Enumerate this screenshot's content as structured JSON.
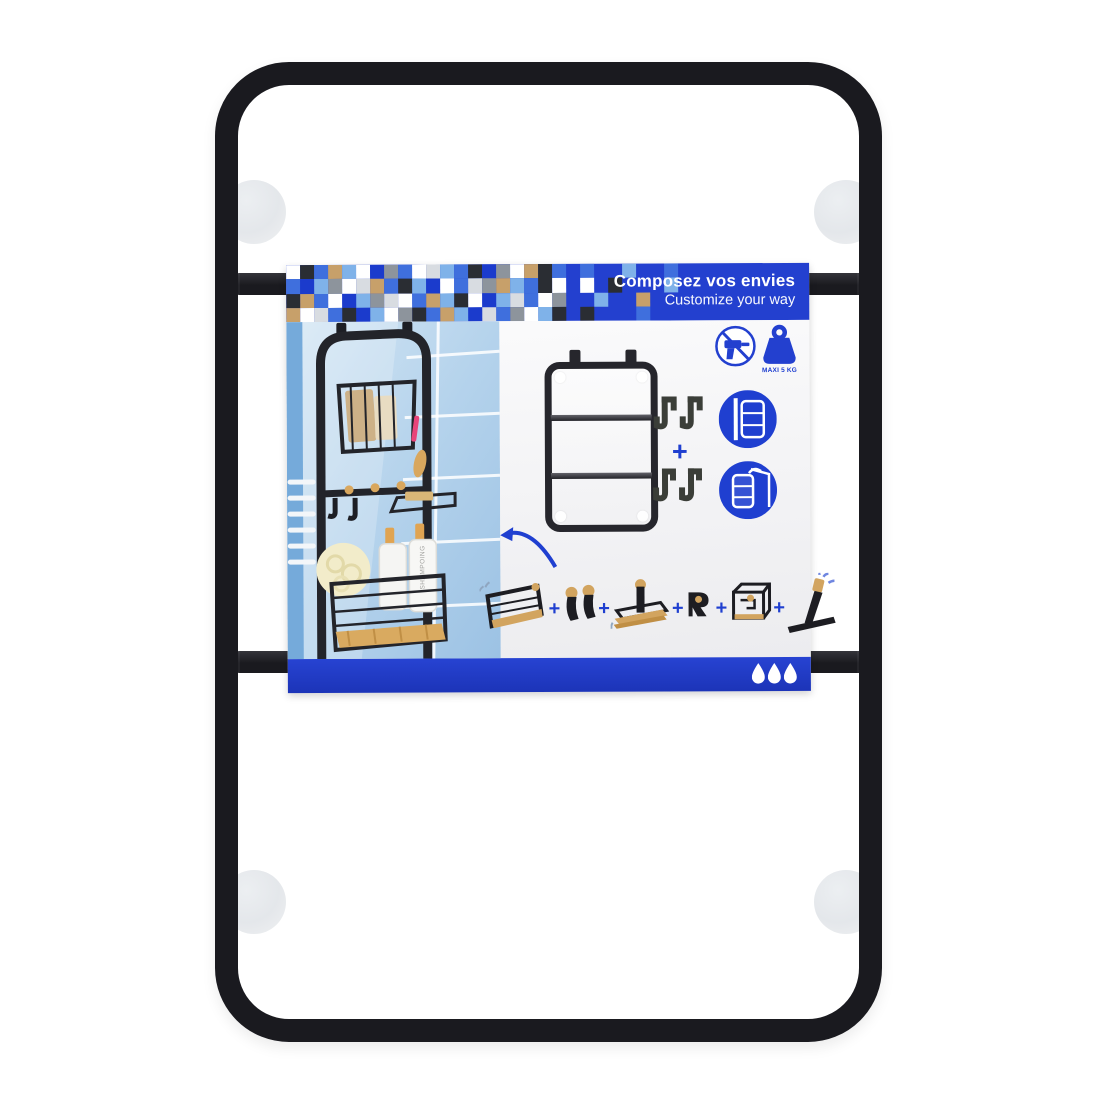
{
  "product": {
    "type": "suction-mount-bathroom-rack",
    "frame_bars": 2,
    "suction_cups": 4
  },
  "package": {
    "banner": {
      "title_fr": "Composez vos envies",
      "subtitle_en": "Customize your way",
      "mosaic_palette": [
        "#1b3bcc",
        "#3f6fdd",
        "#7fb2e9",
        "#ffffff",
        "#d8dce1",
        "#8d949c",
        "#2a2d33",
        "#c7a06a"
      ],
      "mosaic_rows": [
        "36172305134216053761.1..2..1..",
        "10253471620314572163.3.6...2..",
        "67130254317263024135..2..7....",
        "73416023561720415326.6...1...."
      ]
    },
    "badges": {
      "weight_limit_label": "MAXI 5 KG"
    },
    "assembly": {
      "plus_sign": "+"
    },
    "bottle_label": "SHAMPOING",
    "accessories": [
      "wire-basket",
      "peg-hooks",
      "stack-shelf",
      "single-hook",
      "cube-basket",
      "squeegee"
    ],
    "mount_options": [
      "wall-suction-mount",
      "over-door-hang"
    ],
    "hook_sets": [
      "s-hooks",
      "j-hooks"
    ],
    "footer_drops": 3
  },
  "colors": {
    "banner-blue": "#2340cf",
    "strip-blue": "#2743d2",
    "accent-blue": "#1f3fd0",
    "frame-black": "#1a1a1f",
    "icon-black": "#26262c",
    "wood-tan": "#d2a45f",
    "tile-blue": "#a9cbe8",
    "pink-accent": "#e8447a"
  }
}
